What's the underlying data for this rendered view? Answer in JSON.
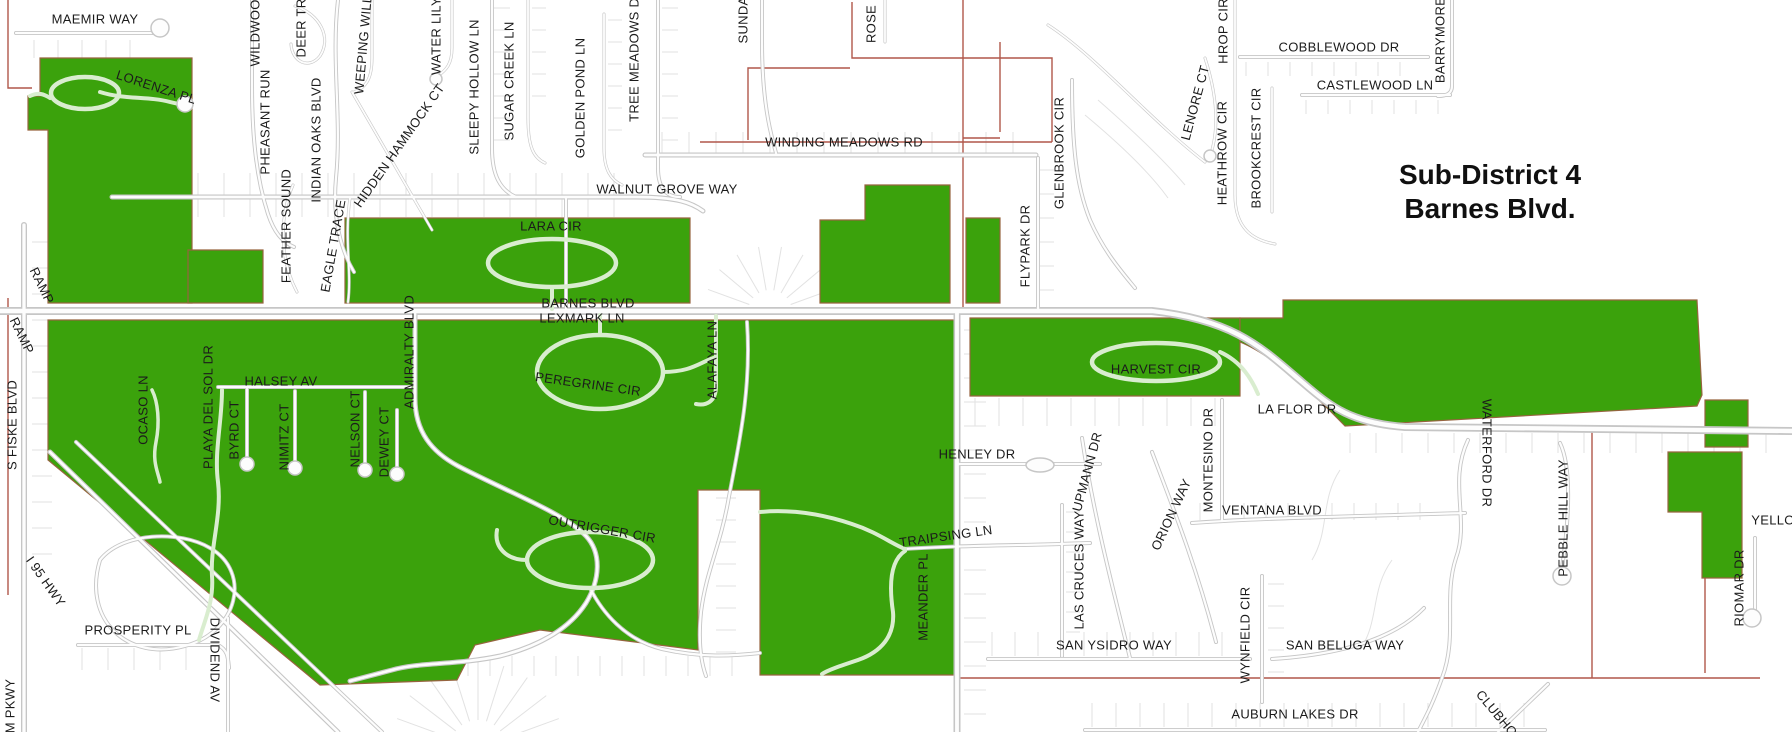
{
  "map": {
    "title": {
      "line1": "Sub-District 4",
      "line2": "Barnes Blvd."
    },
    "colors": {
      "background": "#ffffff",
      "green": "#3ba20c",
      "green_stroke": "#96643f",
      "road_casing": "#c6c6c6",
      "road_fill": "#fdfdfd",
      "pale_road": "#d9edcf",
      "parcel": "#e2e2e2",
      "boundary": "#b0574a",
      "label": "#1b1b1b"
    },
    "labels": [
      {
        "t": "MAEMIR WAY",
        "x": 95,
        "y": 20,
        "r": 0
      },
      {
        "t": "LORENZA PL",
        "x": 156,
        "y": 88,
        "r": 18
      },
      {
        "t": "WILDWOOD",
        "x": 256,
        "y": 28,
        "r": -90
      },
      {
        "t": "DEER TR",
        "x": 302,
        "y": 28,
        "r": -90
      },
      {
        "t": "PHEASANT RUN",
        "x": 266,
        "y": 122,
        "r": -90
      },
      {
        "t": "INDIAN OAKS BLVD",
        "x": 317,
        "y": 140,
        "r": -90
      },
      {
        "t": "FEATHER SOUND",
        "x": 287,
        "y": 226,
        "r": -90
      },
      {
        "t": "EAGLE TRACE",
        "x": 334,
        "y": 246,
        "r": -80
      },
      {
        "t": "WEEPING WILL",
        "x": 364,
        "y": 45,
        "r": -85
      },
      {
        "t": "WATER LILY",
        "x": 437,
        "y": 36,
        "r": -90
      },
      {
        "t": "HIDDEN HAMMOCK CT",
        "x": 400,
        "y": 146,
        "r": -55
      },
      {
        "t": "SLEEPY HOLLOW LN",
        "x": 475,
        "y": 87,
        "r": -90
      },
      {
        "t": "SUGAR CREEK LN",
        "x": 510,
        "y": 81,
        "r": -90
      },
      {
        "t": "GOLDEN POND LN",
        "x": 581,
        "y": 98,
        "r": -90
      },
      {
        "t": "TREE MEADOWS DR",
        "x": 635,
        "y": 55,
        "r": -90
      },
      {
        "t": "SUNDA",
        "x": 744,
        "y": 20,
        "r": -90
      },
      {
        "t": "ROSE",
        "x": 872,
        "y": 24,
        "r": -90
      },
      {
        "t": "WINDING MEADOWS RD",
        "x": 844,
        "y": 143,
        "r": 0
      },
      {
        "t": "WALNUT GROVE WAY",
        "x": 667,
        "y": 190,
        "r": 0
      },
      {
        "t": "LARA CIR",
        "x": 551,
        "y": 227,
        "r": 0
      },
      {
        "t": "BARNES BLVD",
        "x": 588,
        "y": 304,
        "r": 0
      },
      {
        "t": "LEXMARK LN",
        "x": 582,
        "y": 319,
        "r": 0
      },
      {
        "t": "PEREGRINE CIR",
        "x": 588,
        "y": 385,
        "r": 8
      },
      {
        "t": "ALAFAYA LN",
        "x": 713,
        "y": 360,
        "r": -90
      },
      {
        "t": "ADMIRALTY BLVD",
        "x": 410,
        "y": 352,
        "r": -90
      },
      {
        "t": "HALSEY AV",
        "x": 281,
        "y": 382,
        "r": 0
      },
      {
        "t": "OCASO LN",
        "x": 144,
        "y": 410,
        "r": -90
      },
      {
        "t": "PLAYA DEL SOL DR",
        "x": 209,
        "y": 407,
        "r": -90
      },
      {
        "t": "BYRD CT",
        "x": 235,
        "y": 430,
        "r": -90
      },
      {
        "t": "NIMITZ CT",
        "x": 285,
        "y": 437,
        "r": -90
      },
      {
        "t": "NELSON CT",
        "x": 356,
        "y": 429,
        "r": -90
      },
      {
        "t": "DEWEY CT",
        "x": 385,
        "y": 442,
        "r": -90
      },
      {
        "t": "RAMP",
        "x": 41,
        "y": 286,
        "r": 64
      },
      {
        "t": "RAMP",
        "x": 21,
        "y": 336,
        "r": 64
      },
      {
        "t": "S FISKE BLVD",
        "x": 13,
        "y": 425,
        "r": -90
      },
      {
        "t": "I 95 HWY",
        "x": 45,
        "y": 582,
        "r": 55
      },
      {
        "t": "PROSPERITY PL",
        "x": 138,
        "y": 631,
        "r": 0
      },
      {
        "t": "DIVIDEND AV",
        "x": 214,
        "y": 660,
        "r": 90
      },
      {
        "t": "M PKWY",
        "x": 11,
        "y": 706,
        "r": -90
      },
      {
        "t": "OUTRIGGER CIR",
        "x": 602,
        "y": 530,
        "r": 10
      },
      {
        "t": "HENLEY DR",
        "x": 977,
        "y": 455,
        "r": 0
      },
      {
        "t": "TRAIPSING LN",
        "x": 946,
        "y": 537,
        "r": -8
      },
      {
        "t": "MEANDER PL",
        "x": 924,
        "y": 597,
        "r": -90
      },
      {
        "t": "FLYPARK DR",
        "x": 1026,
        "y": 246,
        "r": -90
      },
      {
        "t": "GLENBROOK CIR",
        "x": 1060,
        "y": 153,
        "r": -90
      },
      {
        "t": "LENORE CT",
        "x": 1196,
        "y": 103,
        "r": -75
      },
      {
        "t": "HEATHROW CIR",
        "x": 1223,
        "y": 153,
        "r": -90
      },
      {
        "t": "BROOKCREST CIR",
        "x": 1257,
        "y": 148,
        "r": -90
      },
      {
        "t": "HROP CIR",
        "x": 1224,
        "y": 31,
        "r": -90
      },
      {
        "t": "COBBLEWOOD DR",
        "x": 1339,
        "y": 48,
        "r": 0
      },
      {
        "t": "CASTLEWOOD LN",
        "x": 1375,
        "y": 86,
        "r": 0
      },
      {
        "t": "BARRYMORE",
        "x": 1441,
        "y": 40,
        "r": -90
      },
      {
        "t": "HARVEST CIR",
        "x": 1156,
        "y": 370,
        "r": 0
      },
      {
        "t": "LA FLOR DR",
        "x": 1297,
        "y": 410,
        "r": 0
      },
      {
        "t": "UPMANN DR",
        "x": 1088,
        "y": 472,
        "r": -75
      },
      {
        "t": "LAS CRUCES WAY",
        "x": 1080,
        "y": 570,
        "r": -90
      },
      {
        "t": "ORION WAY",
        "x": 1172,
        "y": 515,
        "r": -65
      },
      {
        "t": "MONTESINO DR",
        "x": 1209,
        "y": 460,
        "r": -90
      },
      {
        "t": "VENTANA BLVD",
        "x": 1272,
        "y": 511,
        "r": 0
      },
      {
        "t": "SAN YSIDRO WAY",
        "x": 1114,
        "y": 646,
        "r": 0
      },
      {
        "t": "WYNFIELD CIR",
        "x": 1246,
        "y": 635,
        "r": -90
      },
      {
        "t": "SAN BELUGA WAY",
        "x": 1345,
        "y": 646,
        "r": 0
      },
      {
        "t": "AUBURN LAKES DR",
        "x": 1295,
        "y": 715,
        "r": 0
      },
      {
        "t": "WATERFORD DR",
        "x": 1486,
        "y": 453,
        "r": 90
      },
      {
        "t": "PEBBLE HILL WAY",
        "x": 1564,
        "y": 518,
        "r": -90
      },
      {
        "t": "RIOMAR DR",
        "x": 1740,
        "y": 588,
        "r": -90
      },
      {
        "t": "YELLO",
        "x": 1773,
        "y": 521,
        "r": 0
      },
      {
        "t": "CLUBHO",
        "x": 1496,
        "y": 714,
        "r": 50
      }
    ],
    "green_areas": [
      {
        "id": "lorenza-block",
        "d": "M28,96 L40,96 L40,58 L192,58 L192,303 L48,303 L48,130 L28,130 Z"
      },
      {
        "id": "feather-sound-block",
        "d": "M188,250 H263 V303 H188 Z"
      },
      {
        "id": "lara-cir-band",
        "d": "M345,218 H690 V303 H345 Z"
      },
      {
        "id": "flypark-west-block",
        "d": "M820,220 H865 V185 H950 V303 H820 Z"
      },
      {
        "id": "flypark-east-block",
        "d": "M966,218 H1000 V303 H966 Z"
      },
      {
        "id": "harvest-band",
        "d": "M970,318 H1240 V396 H970 Z"
      },
      {
        "id": "barnes-east-strip",
        "d": "M1240,318 L1283,318 L1283,300 L1697,300 L1702,395 L1697,406 L1345,426 C1310,390 1272,355 1240,342 Z"
      },
      {
        "id": "riomar-square",
        "d": "M1705,400 H1748 V447 H1705 Z"
      },
      {
        "id": "riomar-block",
        "d": "M1668,452 H1742 V578 H1702 V512 H1668 Z"
      },
      {
        "id": "south-district-block",
        "d": "M48,320 H955 V675 H760 V490 H698 V650 L540,630 L475,645 L457,680 L320,685 L48,460 Z"
      }
    ],
    "roads": [
      {
        "d": "M0,311 H1152 C1235,320 1262,348 1302,382 C1332,408 1352,423 1405,427 L1792,431",
        "w": 8
      },
      {
        "d": "M112,197 H636 C678,197 692,203 703,211",
        "w": 5
      },
      {
        "d": "M645,155 H1036",
        "w": 5
      },
      {
        "d": "M16,33 H152",
        "w": 4
      },
      {
        "d": "M24,225 V732",
        "w": 6
      },
      {
        "d": "M50,452 L338,732",
        "w": 5
      },
      {
        "d": "M76,442 L382,732",
        "w": 4
      },
      {
        "d": "M100,560 C82,620 128,662 185,646 C238,632 252,572 210,548 C180,530 122,532 100,560",
        "w": 4
      },
      {
        "d": "M218,387 H410",
        "w": 4
      },
      {
        "d": "M247,389 V460",
        "w": 4
      },
      {
        "d": "M295,391 V464",
        "w": 4
      },
      {
        "d": "M365,392 V466",
        "w": 4
      },
      {
        "d": "M397,410 V470",
        "w": 4
      },
      {
        "d": "M415,313 V398 C415,432 432,452 458,466 C512,494 562,512 586,536 C602,553 600,580 586,603 C570,628 540,646 500,656 C458,665 420,662 392,670 L350,681",
        "w": 5
      },
      {
        "d": "M566,199 V311",
        "w": 4
      },
      {
        "d": "M957,313 V732",
        "w": 7
      },
      {
        "d": "M1038,158 V311",
        "w": 4
      },
      {
        "d": "M957,464 H1100",
        "w": 4
      },
      {
        "d": "M905,549 C962,545 1010,546 1090,543",
        "w": 4
      },
      {
        "d": "M1192,523 C1262,518 1330,517 1465,513",
        "w": 4
      },
      {
        "d": "M988,659 H1250",
        "w": 4
      },
      {
        "d": "M1262,576 V702",
        "w": 4
      },
      {
        "d": "M1085,730 H1545",
        "w": 4
      },
      {
        "d": "M1272,659 C1335,655 1392,641 1424,608",
        "w": 4
      },
      {
        "d": "M1062,505 V656",
        "w": 4
      },
      {
        "d": "M1082,438 C1092,505 1108,570 1130,658",
        "w": 4
      },
      {
        "d": "M1152,452 C1172,505 1196,565 1216,642",
        "w": 4
      },
      {
        "d": "M1222,400 V521",
        "w": 4
      },
      {
        "d": "M1240,57 H1428",
        "w": 4
      },
      {
        "d": "M1302,95 H1450",
        "w": 4
      },
      {
        "d": "M1452,0 V86 C1452,94 1446,96 1438,96",
        "w": 4
      },
      {
        "d": "M1072,80 C1072,145 1076,185 1090,220 C1104,252 1122,272 1135,288",
        "w": 4
      },
      {
        "d": "M1048,25 C1095,55 1150,120 1205,162",
        "w": 3
      },
      {
        "d": "M1235,0 V195 C1235,228 1252,240 1275,244",
        "w": 3
      },
      {
        "d": "M1272,88 V212",
        "w": 3
      },
      {
        "d": "M1205,58 C1216,92 1219,124 1212,150",
        "w": 3
      },
      {
        "d": "M1468,440 C1448,482 1470,520 1456,558 C1443,598 1458,636 1442,678 C1432,706 1425,718 1418,732",
        "w": 4
      },
      {
        "d": "M1560,443 C1572,468 1569,520 1562,568",
        "w": 4
      },
      {
        "d": "M1755,538 V610",
        "w": 4
      },
      {
        "d": "M78,645 H218 C228,650 228,658 229,668",
        "w": 4
      },
      {
        "d": "M228,618 V732",
        "w": 4
      },
      {
        "d": "M1548,684 L1498,732",
        "w": 4
      },
      {
        "d": "M252,0 V85 C252,140 257,180 268,214 C274,232 282,242 294,247",
        "w": 4
      },
      {
        "d": "M338,0 C331,60 342,118 336,178 C332,220 342,252 354,272",
        "w": 4
      },
      {
        "d": "M295,6 C320,14 332,38 320,56 C309,70 292,62 291,44",
        "w": 3
      },
      {
        "d": "M293,185 C278,220 281,262 297,292",
        "w": 3
      },
      {
        "d": "M350,198 C344,240 352,272 348,302",
        "w": 3
      },
      {
        "d": "M372,0 V58 C372,80 365,88 354,92",
        "w": 3
      },
      {
        "d": "M352,92 L432,230",
        "w": 3
      },
      {
        "d": "M452,0 V48 C452,64 446,70 439,75",
        "w": 3
      },
      {
        "d": "M492,0 V148 C492,175 500,190 516,197",
        "w": 4
      },
      {
        "d": "M528,0 V118 C528,148 534,158 545,163",
        "w": 3
      },
      {
        "d": "M604,14 V148 C604,170 611,180 622,185",
        "w": 3
      },
      {
        "d": "M658,0 V168 C658,190 668,197 680,197",
        "w": 4
      },
      {
        "d": "M762,0 V42 C762,100 770,132 776,153",
        "w": 4
      },
      {
        "d": "M885,0 V42",
        "w": 3
      },
      {
        "d": "M747,322 C752,392 737,452 728,502 C720,546 706,572 701,612 C698,642 701,662 706,676",
        "w": 4
      },
      {
        "d": "M590,588 C602,612 625,640 662,649 C702,658 732,656 760,653",
        "w": 4
      }
    ],
    "pale_roads": [
      {
        "d": "M100,92 C125,100 148,96 170,102 C178,104 183,105 185,104",
        "w": 4
      },
      {
        "d": "M30,96 C38,92 44,94 50,98",
        "w": 4
      },
      {
        "d": "M552,287 V309",
        "w": 4
      },
      {
        "d": "M600,335 V315",
        "w": 4
      },
      {
        "d": "M663,372 C692,372 700,362 716,357",
        "w": 4
      },
      {
        "d": "M716,316 V386 C716,402 706,406 696,404",
        "w": 4
      },
      {
        "d": "M527,560 C505,560 494,546 497,530",
        "w": 4
      },
      {
        "d": "M1220,352 C1242,362 1252,380 1258,394",
        "w": 4
      },
      {
        "d": "M905,551 C888,562 890,592 893,612 C895,636 881,652 858,660 C840,666 828,670 822,674",
        "w": 4
      },
      {
        "d": "M760,512 C792,509 822,514 852,524 C877,532 892,544 905,549",
        "w": 4
      },
      {
        "d": "M222,390 C222,422 214,452 218,482 C222,516 210,546 212,576 C214,602 204,622 199,640",
        "w": 4
      },
      {
        "d": "M152,390 C158,402 160,422 156,442 C152,462 158,472 160,482",
        "w": 3.5
      }
    ],
    "loops": [
      {
        "cx": 85,
        "cy": 93,
        "rx": 34,
        "ry": 16
      },
      {
        "cx": 552,
        "cy": 263,
        "rx": 64,
        "ry": 24
      },
      {
        "cx": 600,
        "cy": 372,
        "rx": 63,
        "ry": 37
      },
      {
        "cx": 590,
        "cy": 560,
        "rx": 63,
        "ry": 28
      },
      {
        "cx": 1156,
        "cy": 362,
        "rx": 64,
        "ry": 19
      }
    ],
    "bulbs": [
      {
        "x": 160,
        "y": 28,
        "r": 9
      },
      {
        "x": 247,
        "y": 464,
        "r": 7
      },
      {
        "x": 295,
        "y": 468,
        "r": 7
      },
      {
        "x": 365,
        "y": 470,
        "r": 7
      },
      {
        "x": 397,
        "y": 474,
        "r": 7
      },
      {
        "x": 436,
        "y": 79,
        "r": 6
      },
      {
        "x": 1210,
        "y": 156,
        "r": 6
      },
      {
        "x": 1562,
        "y": 576,
        "r": 9
      },
      {
        "x": 1752,
        "y": 618,
        "r": 9
      },
      {
        "x": 1040,
        "y": 465,
        "rx": 14,
        "ry": 7
      },
      {
        "x": 185,
        "y": 104,
        "r": 8
      }
    ],
    "boundaries": [
      "M8,0 V88 L32,88",
      "M8,298 V595",
      "M748,140 V68 H850",
      "M852,2 V58 H1052 V142",
      "M700,142 H1052",
      "M963,0 V308",
      "M1000,42 V132",
      "M963,138 H1000",
      "M958,678 H1760",
      "M1592,432 V678",
      "M1705,578 V673"
    ],
    "parcel_ticks": [
      {
        "o": "h",
        "y": 173,
        "len": 24,
        "from": 120,
        "to": 632,
        "step": 26
      },
      {
        "o": "h",
        "y": 132,
        "len": 22,
        "from": 662,
        "to": 1030,
        "step": 27
      },
      {
        "o": "h",
        "y": 40,
        "len": 18,
        "from": 34,
        "to": 148,
        "step": 24
      },
      {
        "o": "h",
        "y": 398,
        "len": 28,
        "from": 975,
        "to": 1235,
        "step": 24
      },
      {
        "o": "h",
        "y": 632,
        "len": 24,
        "from": 992,
        "to": 1244,
        "step": 23
      },
      {
        "o": "h",
        "y": 703,
        "len": 24,
        "from": 1092,
        "to": 1530,
        "step": 24
      },
      {
        "o": "v",
        "x": 964,
        "len": 22,
        "from": 330,
        "to": 716,
        "step": 24
      },
      {
        "o": "v",
        "x": 32,
        "len": 20,
        "from": 242,
        "to": 556,
        "step": 26
      },
      {
        "o": "h",
        "y": 503,
        "len": 17,
        "from": 1200,
        "to": 1438,
        "step": 22
      },
      {
        "o": "v",
        "x": 1268,
        "len": 16,
        "from": 584,
        "to": 692,
        "step": 22
      },
      {
        "o": "h",
        "y": 656,
        "len": 20,
        "from": 468,
        "to": 748,
        "step": 22
      },
      {
        "o": "v",
        "x": 716,
        "len": 20,
        "from": 498,
        "to": 652,
        "step": 22
      },
      {
        "o": "h",
        "y": 648,
        "len": 22,
        "from": 82,
        "to": 208,
        "step": 26
      },
      {
        "o": "h",
        "y": 62,
        "len": 14,
        "from": 1246,
        "to": 1420,
        "step": 22
      },
      {
        "o": "h",
        "y": 100,
        "len": 14,
        "from": 1306,
        "to": 1444,
        "step": 22
      },
      {
        "o": "v",
        "x": 1066,
        "len": 14,
        "from": 512,
        "to": 648,
        "step": 20
      },
      {
        "o": "v",
        "x": 494,
        "len": 16,
        "from": 8,
        "to": 140,
        "step": 22
      },
      {
        "o": "v",
        "x": 532,
        "len": 14,
        "from": 8,
        "to": 112,
        "step": 22
      },
      {
        "o": "v",
        "x": 608,
        "len": 14,
        "from": 20,
        "to": 142,
        "step": 22
      },
      {
        "o": "v",
        "x": 662,
        "len": 16,
        "from": 8,
        "to": 160,
        "step": 22
      },
      {
        "o": "h",
        "y": 199,
        "len": 18,
        "from": 120,
        "to": 632,
        "step": 26
      },
      {
        "o": "v",
        "x": 1040,
        "len": 14,
        "from": 170,
        "to": 300,
        "step": 24
      },
      {
        "o": "h",
        "y": 433,
        "len": 20,
        "from": 1350,
        "to": 1780,
        "step": 26
      }
    ],
    "parcel_fans": [
      {
        "cx": 770,
        "cy": 312,
        "r1": 22,
        "r2": 66,
        "a1": 200,
        "a2": 340,
        "n": 8
      },
      {
        "cx": 478,
        "cy": 748,
        "r1": 28,
        "r2": 86,
        "a1": 200,
        "a2": 340,
        "n": 9
      }
    ],
    "parcel_arcs": [
      "M1085,115 C1115,140 1148,170 1168,198",
      "M1098,100 C1130,128 1162,158 1185,185",
      "M1392,560 C1370,590 1380,620 1360,650",
      "M1340,470 C1320,500 1330,530 1312,560"
    ]
  }
}
